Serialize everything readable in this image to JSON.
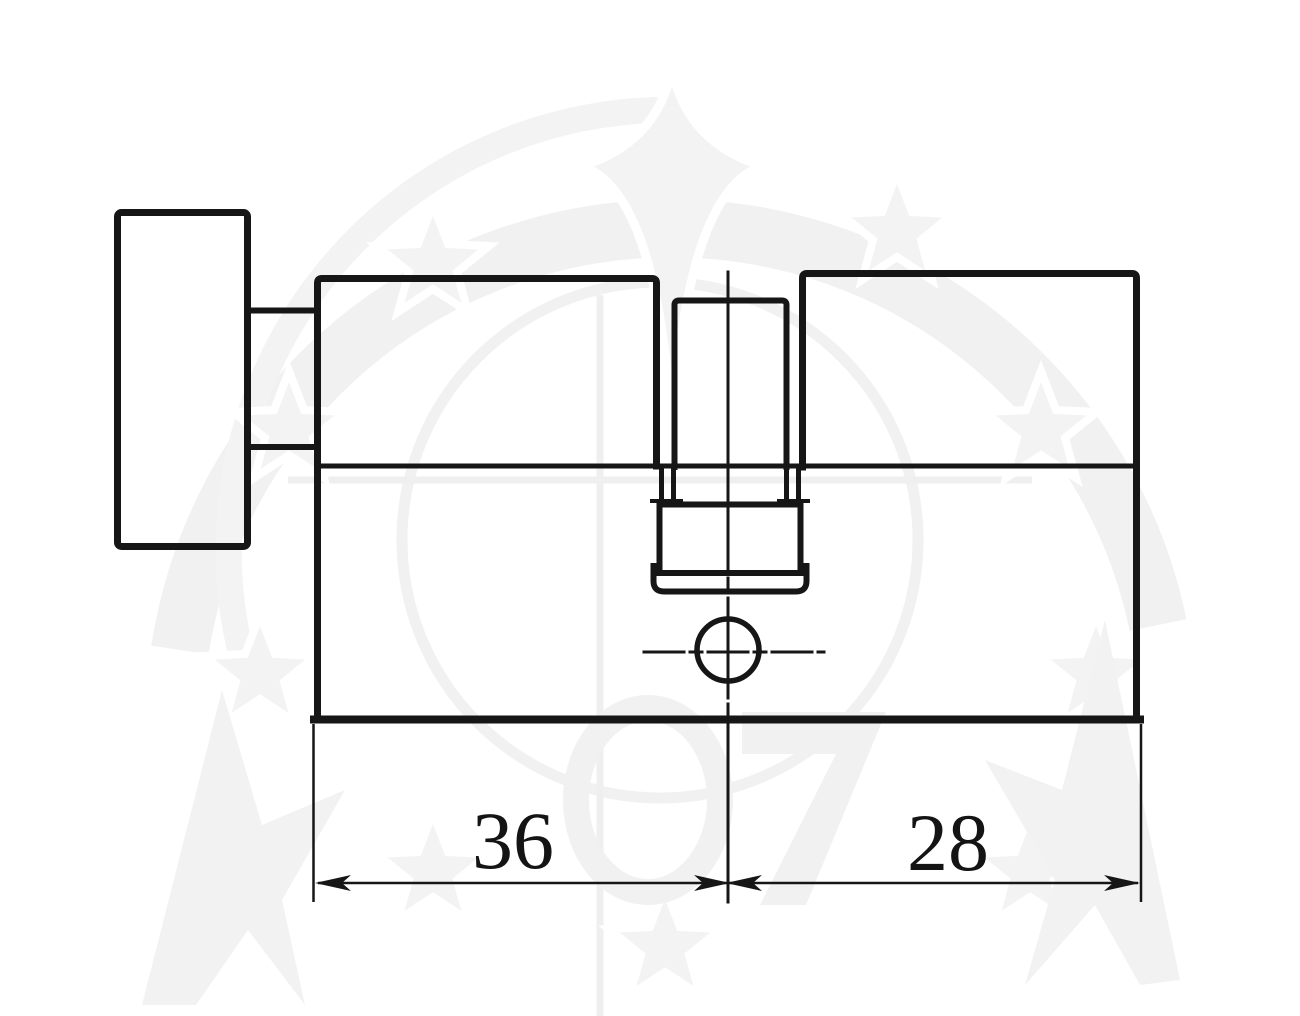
{
  "page": {
    "background": "#ffffff"
  },
  "drawing": {
    "type": "technical drawing",
    "subject": "profile lock cylinder with thumbturn, side elevation",
    "line_color": "#161616",
    "watermark_color": "#f1f1f1",
    "dimensions": {
      "left_segment_label": "36",
      "right_segment_label": "28"
    }
  }
}
